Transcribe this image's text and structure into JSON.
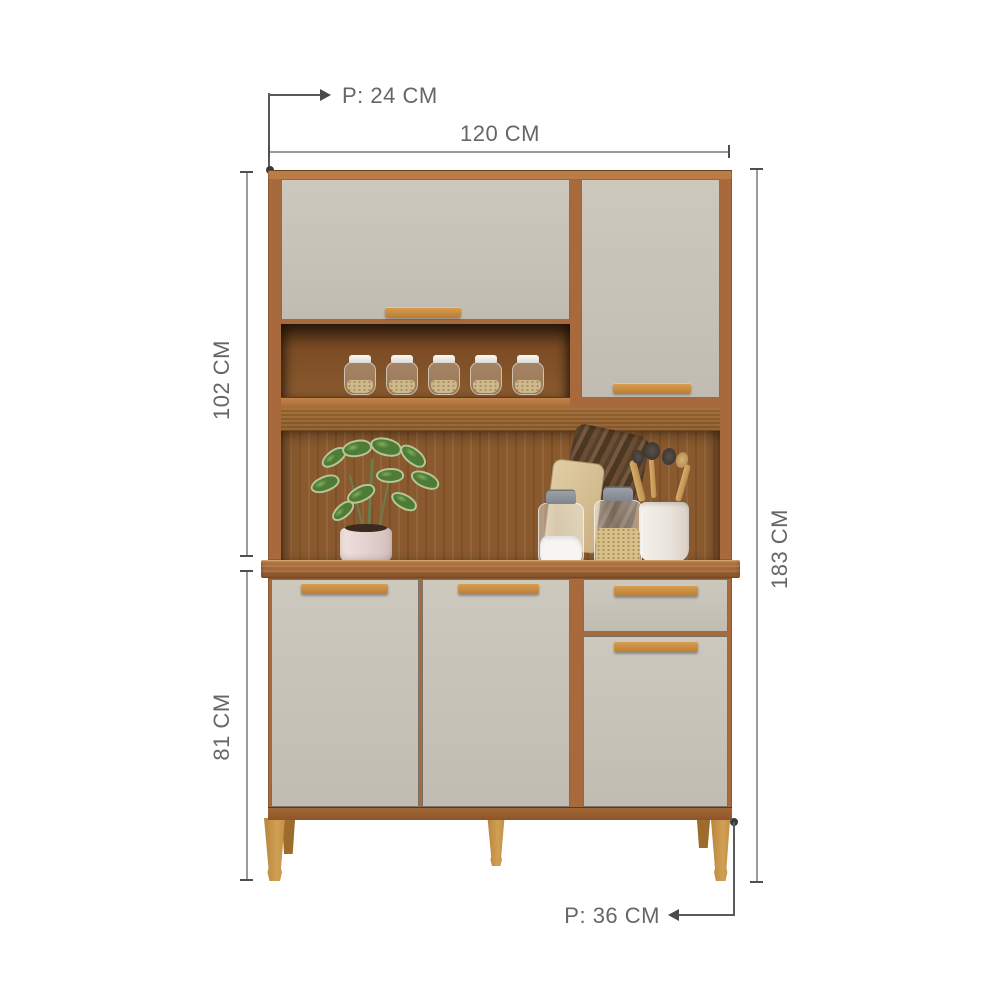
{
  "dimensions": {
    "top_depth": "P: 24 CM",
    "width": "120 CM",
    "upper_height": "102 CM",
    "lower_height": "81 CM",
    "total_height": "183 CM",
    "bottom_depth": "P: 36 CM"
  },
  "colors": {
    "wood": "#a86a3c",
    "wood_light": "#bb7c46",
    "wood_dark": "#7e4e25",
    "niche": "#8a5a2e",
    "compartment": "#6b3f1d",
    "countertop": "#ab6d3e",
    "door": "#c6c2b7",
    "handle_light": "#d99f52",
    "handle_dark": "#bd7f35",
    "leg": "#c99344",
    "leg_dark": "#9c6c2d",
    "dim_line": "#9b9b9b",
    "dim_strong": "#4f4f4f",
    "dim_text": "#666666",
    "background": "#ffffff"
  }
}
